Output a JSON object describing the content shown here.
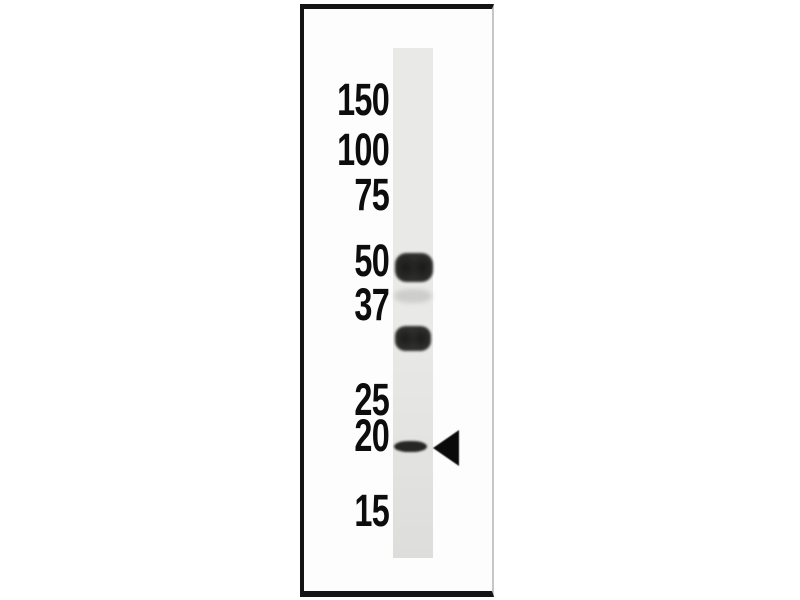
{
  "figure": {
    "kind": "western-blot-lane",
    "unit": "kDa"
  },
  "colors": {
    "background": "#ffffff",
    "frame_border": "#141414",
    "frame_border_right": "#c6c6c6",
    "panel_fill": "#fdfdfd",
    "lane_top": "#e9e9e7",
    "lane_bottom": "#dddddb",
    "label_text": "#0d0d0d",
    "band_dark": "#1f1f1d",
    "band_faint": "#c2c2c0",
    "arrow": "#0a0a0a"
  },
  "ladder": {
    "unit": "kDa",
    "labels": [
      {
        "text": "150",
        "top": 77
      },
      {
        "text": "100",
        "top": 127
      },
      {
        "text": "75",
        "top": 172
      },
      {
        "text": "50",
        "top": 238
      },
      {
        "text": "37",
        "top": 282
      },
      {
        "text": "25",
        "top": 377
      },
      {
        "text": "20",
        "top": 413
      },
      {
        "text": "15",
        "top": 488
      }
    ]
  },
  "bands": [
    {
      "approx_kda": 50,
      "intensity": "strong",
      "shape": "blob",
      "left": 395,
      "top": 253,
      "width": 38,
      "height": 29,
      "color": "#262624",
      "opacity": 0.96
    },
    {
      "approx_kda": 40,
      "intensity": "faint",
      "shape": "smudge",
      "left": 394,
      "top": 289,
      "width": 38,
      "height": 14,
      "color": "#c2c2c0",
      "opacity": 0.7
    },
    {
      "approx_kda": 33,
      "intensity": "strong",
      "shape": "blob",
      "left": 395,
      "top": 326,
      "width": 36,
      "height": 25,
      "color": "#262624",
      "opacity": 0.95
    },
    {
      "approx_kda": 19,
      "intensity": "strong",
      "shape": "thin",
      "left": 394,
      "top": 441,
      "width": 33,
      "height": 11,
      "color": "#1c1c1a",
      "opacity": 0.95
    }
  ],
  "pointer": {
    "glyph": "left-triangle",
    "color": "#0a0a0a",
    "target_band_kda": 19
  }
}
